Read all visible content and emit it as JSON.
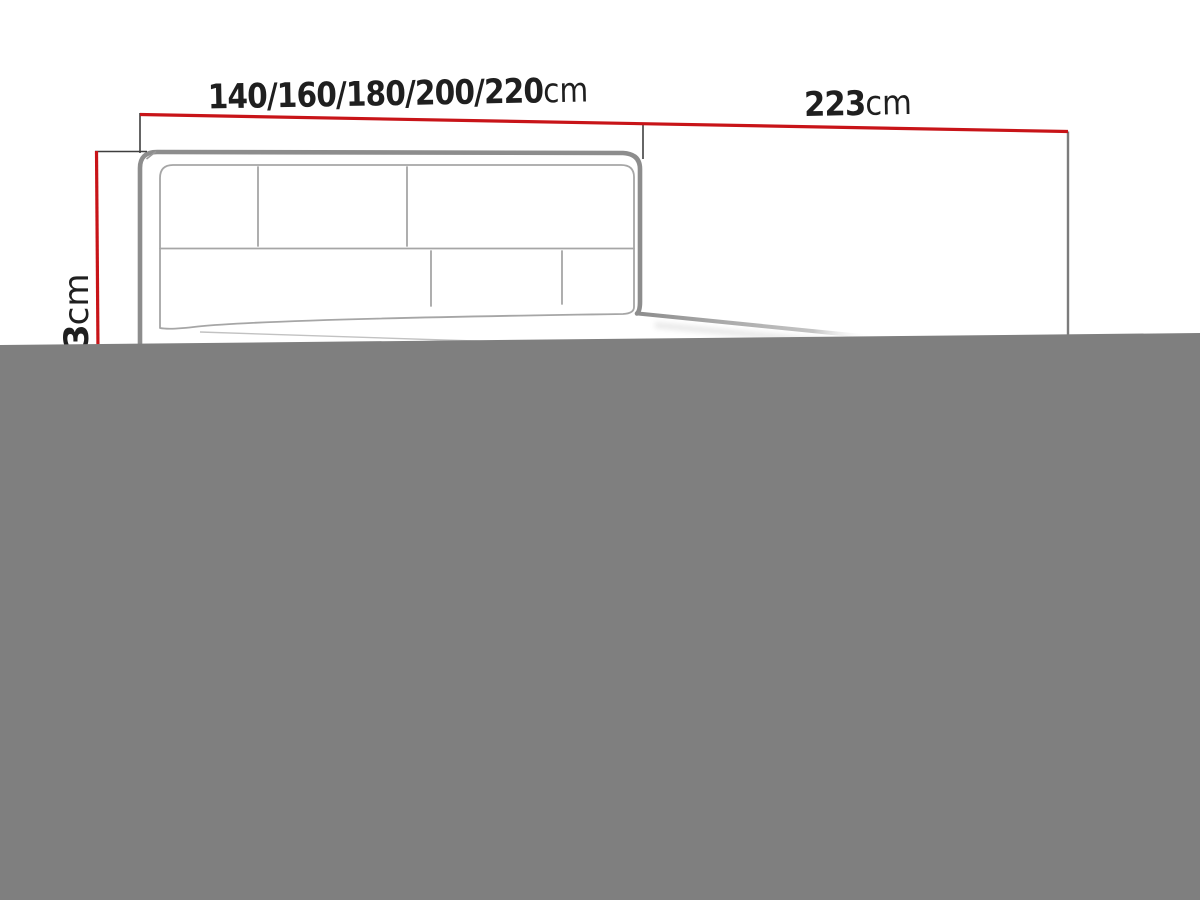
{
  "diagram": {
    "type": "furniture-dimension-drawing",
    "subject": "upholstered bed with panelled headboard, perspective line drawing, lower part covered by gray block",
    "dimensions": {
      "width": {
        "value": "140/160/180/200/220",
        "unit": "cm"
      },
      "length": {
        "value": "223",
        "unit": "cm"
      },
      "height_visible": {
        "value": "3",
        "unit": "cm"
      }
    },
    "colors": {
      "dimension_line": "#c81418",
      "tick_line": "#3f3f3f",
      "extension_line": "#7c7c7c",
      "drawing_line": "#8d8d8d",
      "seam_line": "#a6a6a6",
      "label_text": "#1f1f1f",
      "censor_block": "#7f7f7f",
      "background": "#ffffff"
    }
  }
}
